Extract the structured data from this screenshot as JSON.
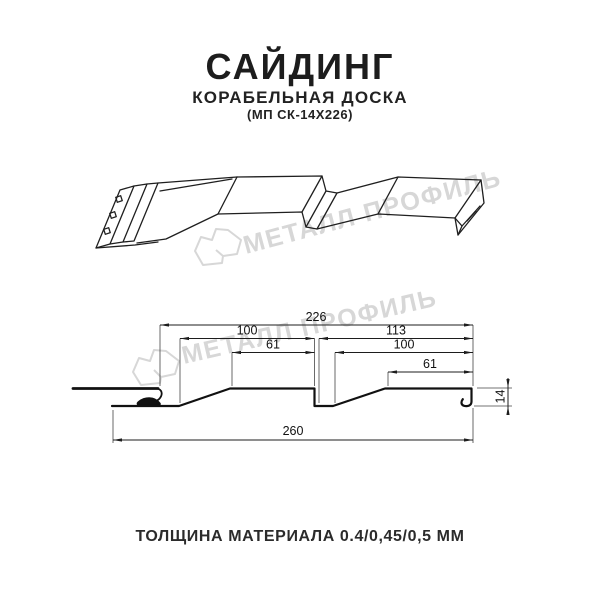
{
  "header": {
    "title": "САЙДИНГ",
    "subtitle": "КОРАБЕЛЬНАЯ ДОСКА",
    "product_code": "(МП СК-14Х226)"
  },
  "watermark": {
    "brand": "МЕТАЛЛ ПРОФИЛЬ",
    "color": "#d7d7d7"
  },
  "cross_section": {
    "dimensions": {
      "overall_top": "226",
      "panel1_width": "100",
      "panel2_width": "113",
      "panel1_flat": "61",
      "panel2_inner": "100",
      "panel2_flat": "61",
      "profile_height": "14",
      "overall_bottom": "260"
    }
  },
  "footer": {
    "thickness_label": "ТОЛЩИНА МАТЕРИАЛА 0.4/0,45/0,5 ММ"
  },
  "colors": {
    "ink": "#1d1d1d",
    "profile_line": "#111111",
    "dimension_line": "#222222",
    "background": "#ffffff"
  }
}
